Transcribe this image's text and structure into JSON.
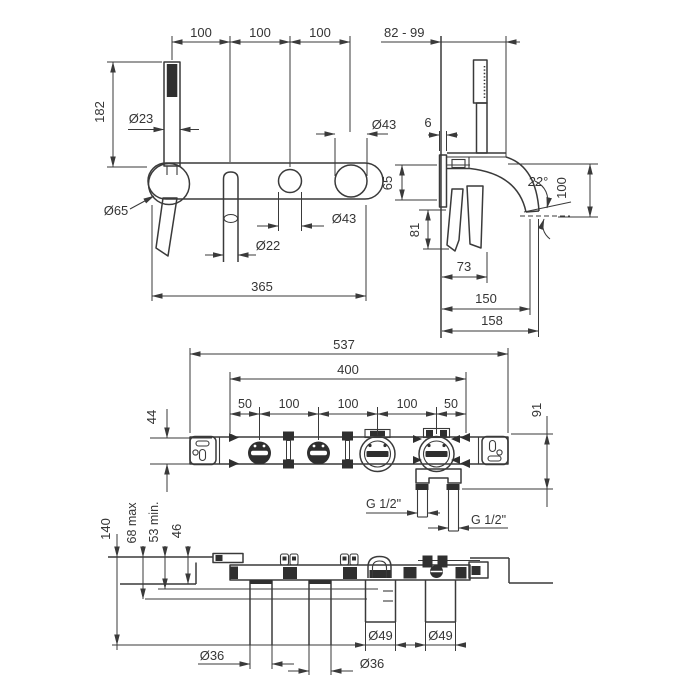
{
  "front_view": {
    "spacing_1": "100",
    "spacing_2": "100",
    "spacing_3": "100",
    "handshower_height": "182",
    "handshower_dia": "Ø23",
    "handle_dia_top": "Ø43",
    "holder_dia": "Ø65",
    "handle_dia_bottom": "Ø43",
    "spout_dia": "Ø22",
    "total_width": "365"
  },
  "side_view": {
    "wall_depth_range": "82 - 99",
    "plate_thickness": "6",
    "body_height": "65",
    "handle_drop": "81",
    "spout_angle": "22°",
    "spout_drop": "100",
    "handle_reach": "73",
    "spout_reach": "150",
    "total_reach": "158"
  },
  "rough_in_view": {
    "total_width": "537",
    "mount_width": "400",
    "seg_1": "50",
    "seg_2": "100",
    "seg_3": "100",
    "seg_4": "100",
    "seg_5": "50",
    "body_height": "44",
    "depth": "91",
    "thread_left": "G 1/2\"",
    "thread_right": "G 1/2\""
  },
  "plan_view": {
    "total_depth": "140",
    "max_depth": "68 max",
    "min_depth": "53 min.",
    "plate_depth": "46",
    "cartridge_dia_1": "Ø49",
    "cartridge_dia_2": "Ø49",
    "tube_dia_1": "Ø36",
    "tube_dia_2": "Ø36"
  }
}
